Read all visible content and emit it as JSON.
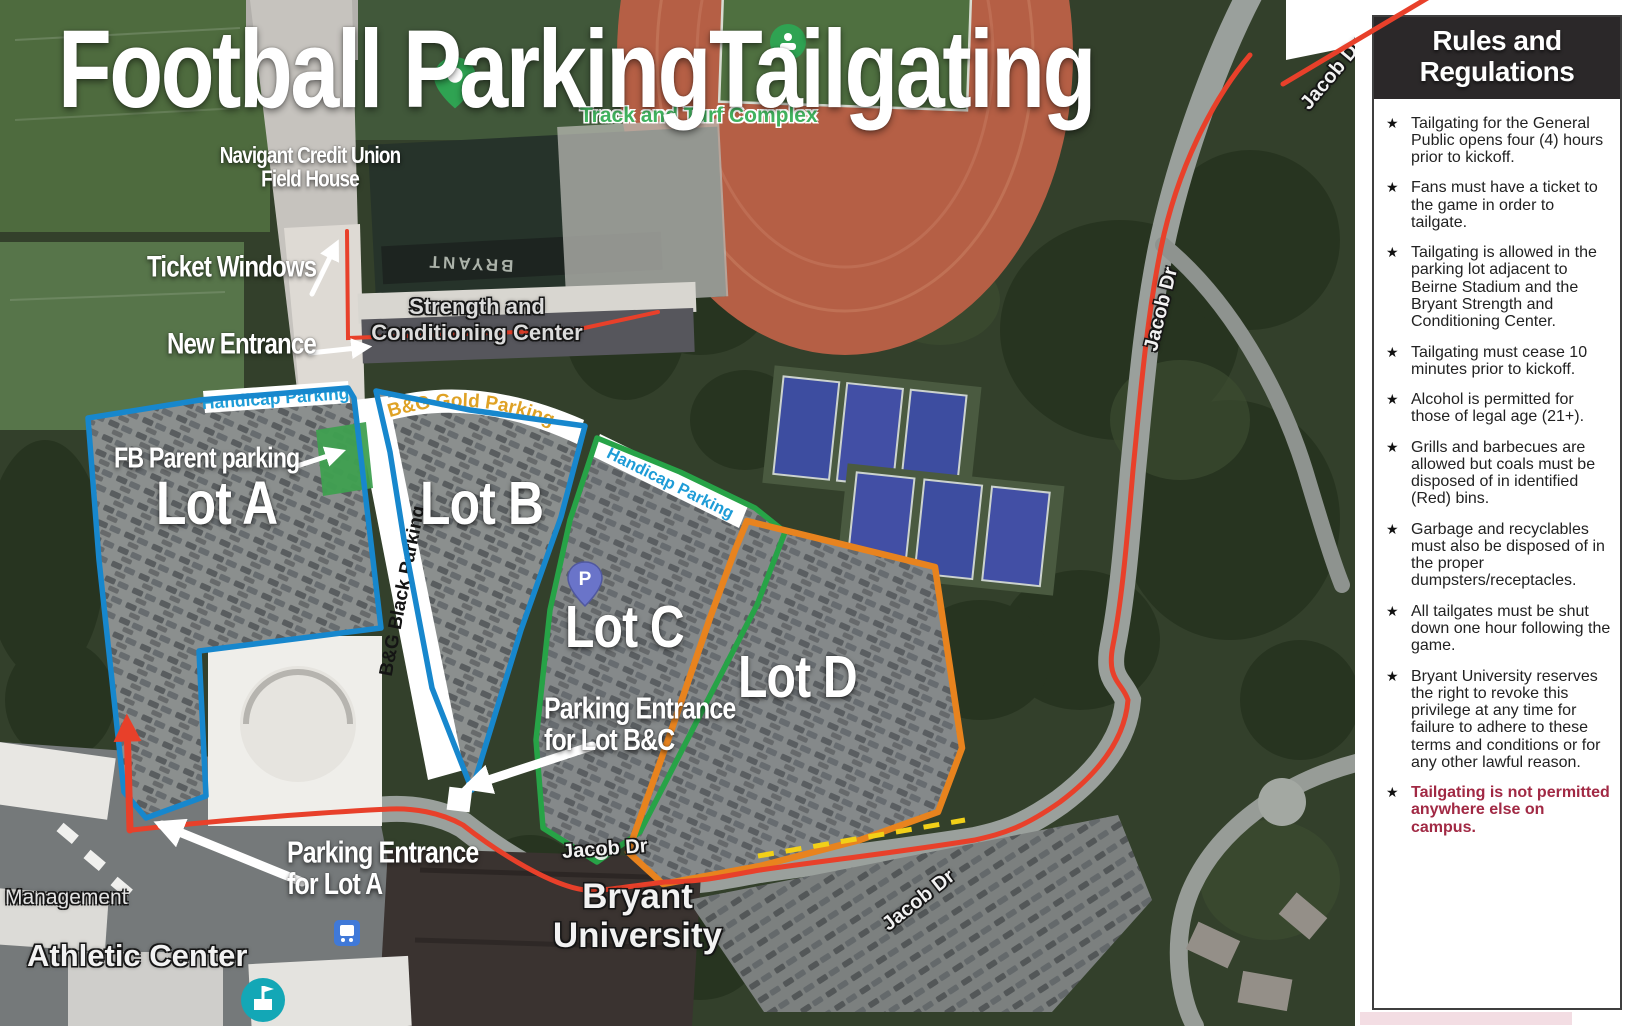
{
  "title": {
    "left": "Football Parking",
    "right": "Tailgating"
  },
  "map": {
    "labels": {
      "field_house": "Navigant Credit Union\nField House",
      "ticket_windows": "Ticket Windows",
      "new_entrance": "New Entrance",
      "strength_center": "Strength and\nConditioning Center",
      "turf_complex": "Track and Turf Complex",
      "bryant_field": "BRYANT",
      "handicap_lot_a": "Handicap Parking",
      "bg_gold": "B&G Gold Parking",
      "bg_black": "B&G Black Parking",
      "fb_parent": "FB Parent parking",
      "lot_a": "Lot A",
      "lot_b": "Lot B",
      "lot_c": "Lot C",
      "lot_d": "Lot D",
      "handicap_lot_c": "Handicap Parking",
      "entrance_bc": "Parking Entrance\nfor Lot B&C",
      "entrance_a": "Parking Entrance\nfor Lot A",
      "jacob_dr": "Jacob Dr",
      "bryant_university": "Bryant\nUniversity",
      "management": "Management",
      "athletic_center": "Athletic Center"
    },
    "markers": {
      "parking_pin": "P"
    },
    "colors": {
      "lot_ab_outline": "#1787cd",
      "lot_c_outline": "#27a347",
      "lot_d_outline": "#e8831e",
      "route_red": "#e8402a",
      "dash_yellow": "#f2d018",
      "handicap_text": "#1e9cd7",
      "gold_text": "#dfa225",
      "parent_parking_fill": "#3fa050"
    }
  },
  "sidebar": {
    "title": "Rules and\nRegulations",
    "star_bullet": "★",
    "rules": [
      {
        "text": "Tailgating for the General Public opens four (4) hours prior to kickoff.",
        "emphasis": false
      },
      {
        "text": "Fans must have a ticket to the game in order to tailgate.",
        "emphasis": false
      },
      {
        "text": "Tailgating is allowed in the parking lot adjacent to Beirne Stadium and the Bryant Strength and Conditioning Center.",
        "emphasis": false
      },
      {
        "text": "Tailgating must cease 10 minutes prior to kickoff.",
        "emphasis": false
      },
      {
        "text": "Alcohol is permitted for those of legal age (21+).",
        "emphasis": false
      },
      {
        "text": "Grills and barbecues are allowed but coals must be disposed of in identified (Red) bins.",
        "emphasis": false
      },
      {
        "text": "Garbage and recyclables must also be disposed of in the proper dumpsters/receptacles.",
        "emphasis": false
      },
      {
        "text": "All tailgates must be shut down one hour following the game.",
        "emphasis": false
      },
      {
        "text": "Bryant University reserves the right to revoke this privilege at any time for failure to adhere to these terms and conditions or for any other lawful reason.",
        "emphasis": false
      },
      {
        "text": "Tailgating is not permitted anywhere else on campus.",
        "emphasis": true
      }
    ]
  }
}
